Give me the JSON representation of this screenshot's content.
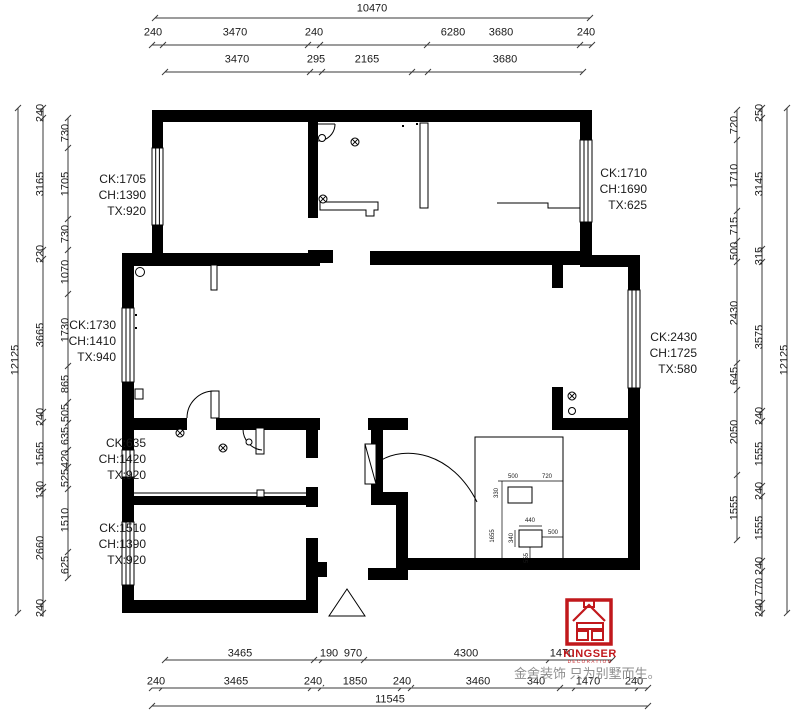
{
  "dimensions": {
    "top": {
      "overall": "10470",
      "row2": [
        "240",
        "3470",
        "240",
        "6280",
        "3680",
        "240"
      ],
      "row3": [
        "3470",
        "295",
        "2165",
        "3680"
      ]
    },
    "bottom": {
      "row1": [
        "3465",
        "190",
        "970",
        "4300",
        "1470"
      ],
      "row2": [
        "240",
        "3465",
        "240",
        "1850",
        "240",
        "3460",
        "340",
        "1470",
        "240"
      ],
      "overall": "11545"
    },
    "left": {
      "overall": "12125",
      "mid": [
        "240",
        "3165",
        "220",
        "3665",
        "240",
        "1565",
        "130",
        "2660",
        "240"
      ],
      "inner": [
        "730",
        "1705",
        "730",
        "1070",
        "1730",
        "865",
        "505",
        "635",
        "420",
        "525",
        "1510",
        "625"
      ]
    },
    "right": {
      "overall": "12125",
      "inner": [
        "720",
        "1710",
        "715",
        "500",
        "2430",
        "645",
        "2050",
        "1555"
      ],
      "mid": [
        "250",
        "3145",
        "315",
        "3575",
        "240",
        "1555",
        "240",
        "1555",
        "240",
        "770",
        "240"
      ]
    }
  },
  "windows": [
    {
      "ck": "CK:1705",
      "ch": "CH:1390",
      "tx": "TX:920"
    },
    {
      "ck": "CK:1730",
      "ch": "CH:1410",
      "tx": "TX:940"
    },
    {
      "ck": "CK:635",
      "ch": "CH:1420",
      "tx": "TX:920"
    },
    {
      "ck": "CK:1510",
      "ch": "CH:1390",
      "tx": "TX:920"
    },
    {
      "ck": "CK:1710",
      "ch": "CH:1690",
      "tx": "TX:625"
    },
    {
      "ck": "CK:2430",
      "ch": "CH:1725",
      "tx": "TX:580"
    }
  ],
  "inset": {
    "labels": [
      "500",
      "720",
      "330",
      "1655",
      "440",
      "340",
      "500",
      "555"
    ]
  },
  "logo": {
    "name": "KINGSER",
    "sub": "DECORATION",
    "tagline": "金舍装饰 只为别墅而生。"
  }
}
